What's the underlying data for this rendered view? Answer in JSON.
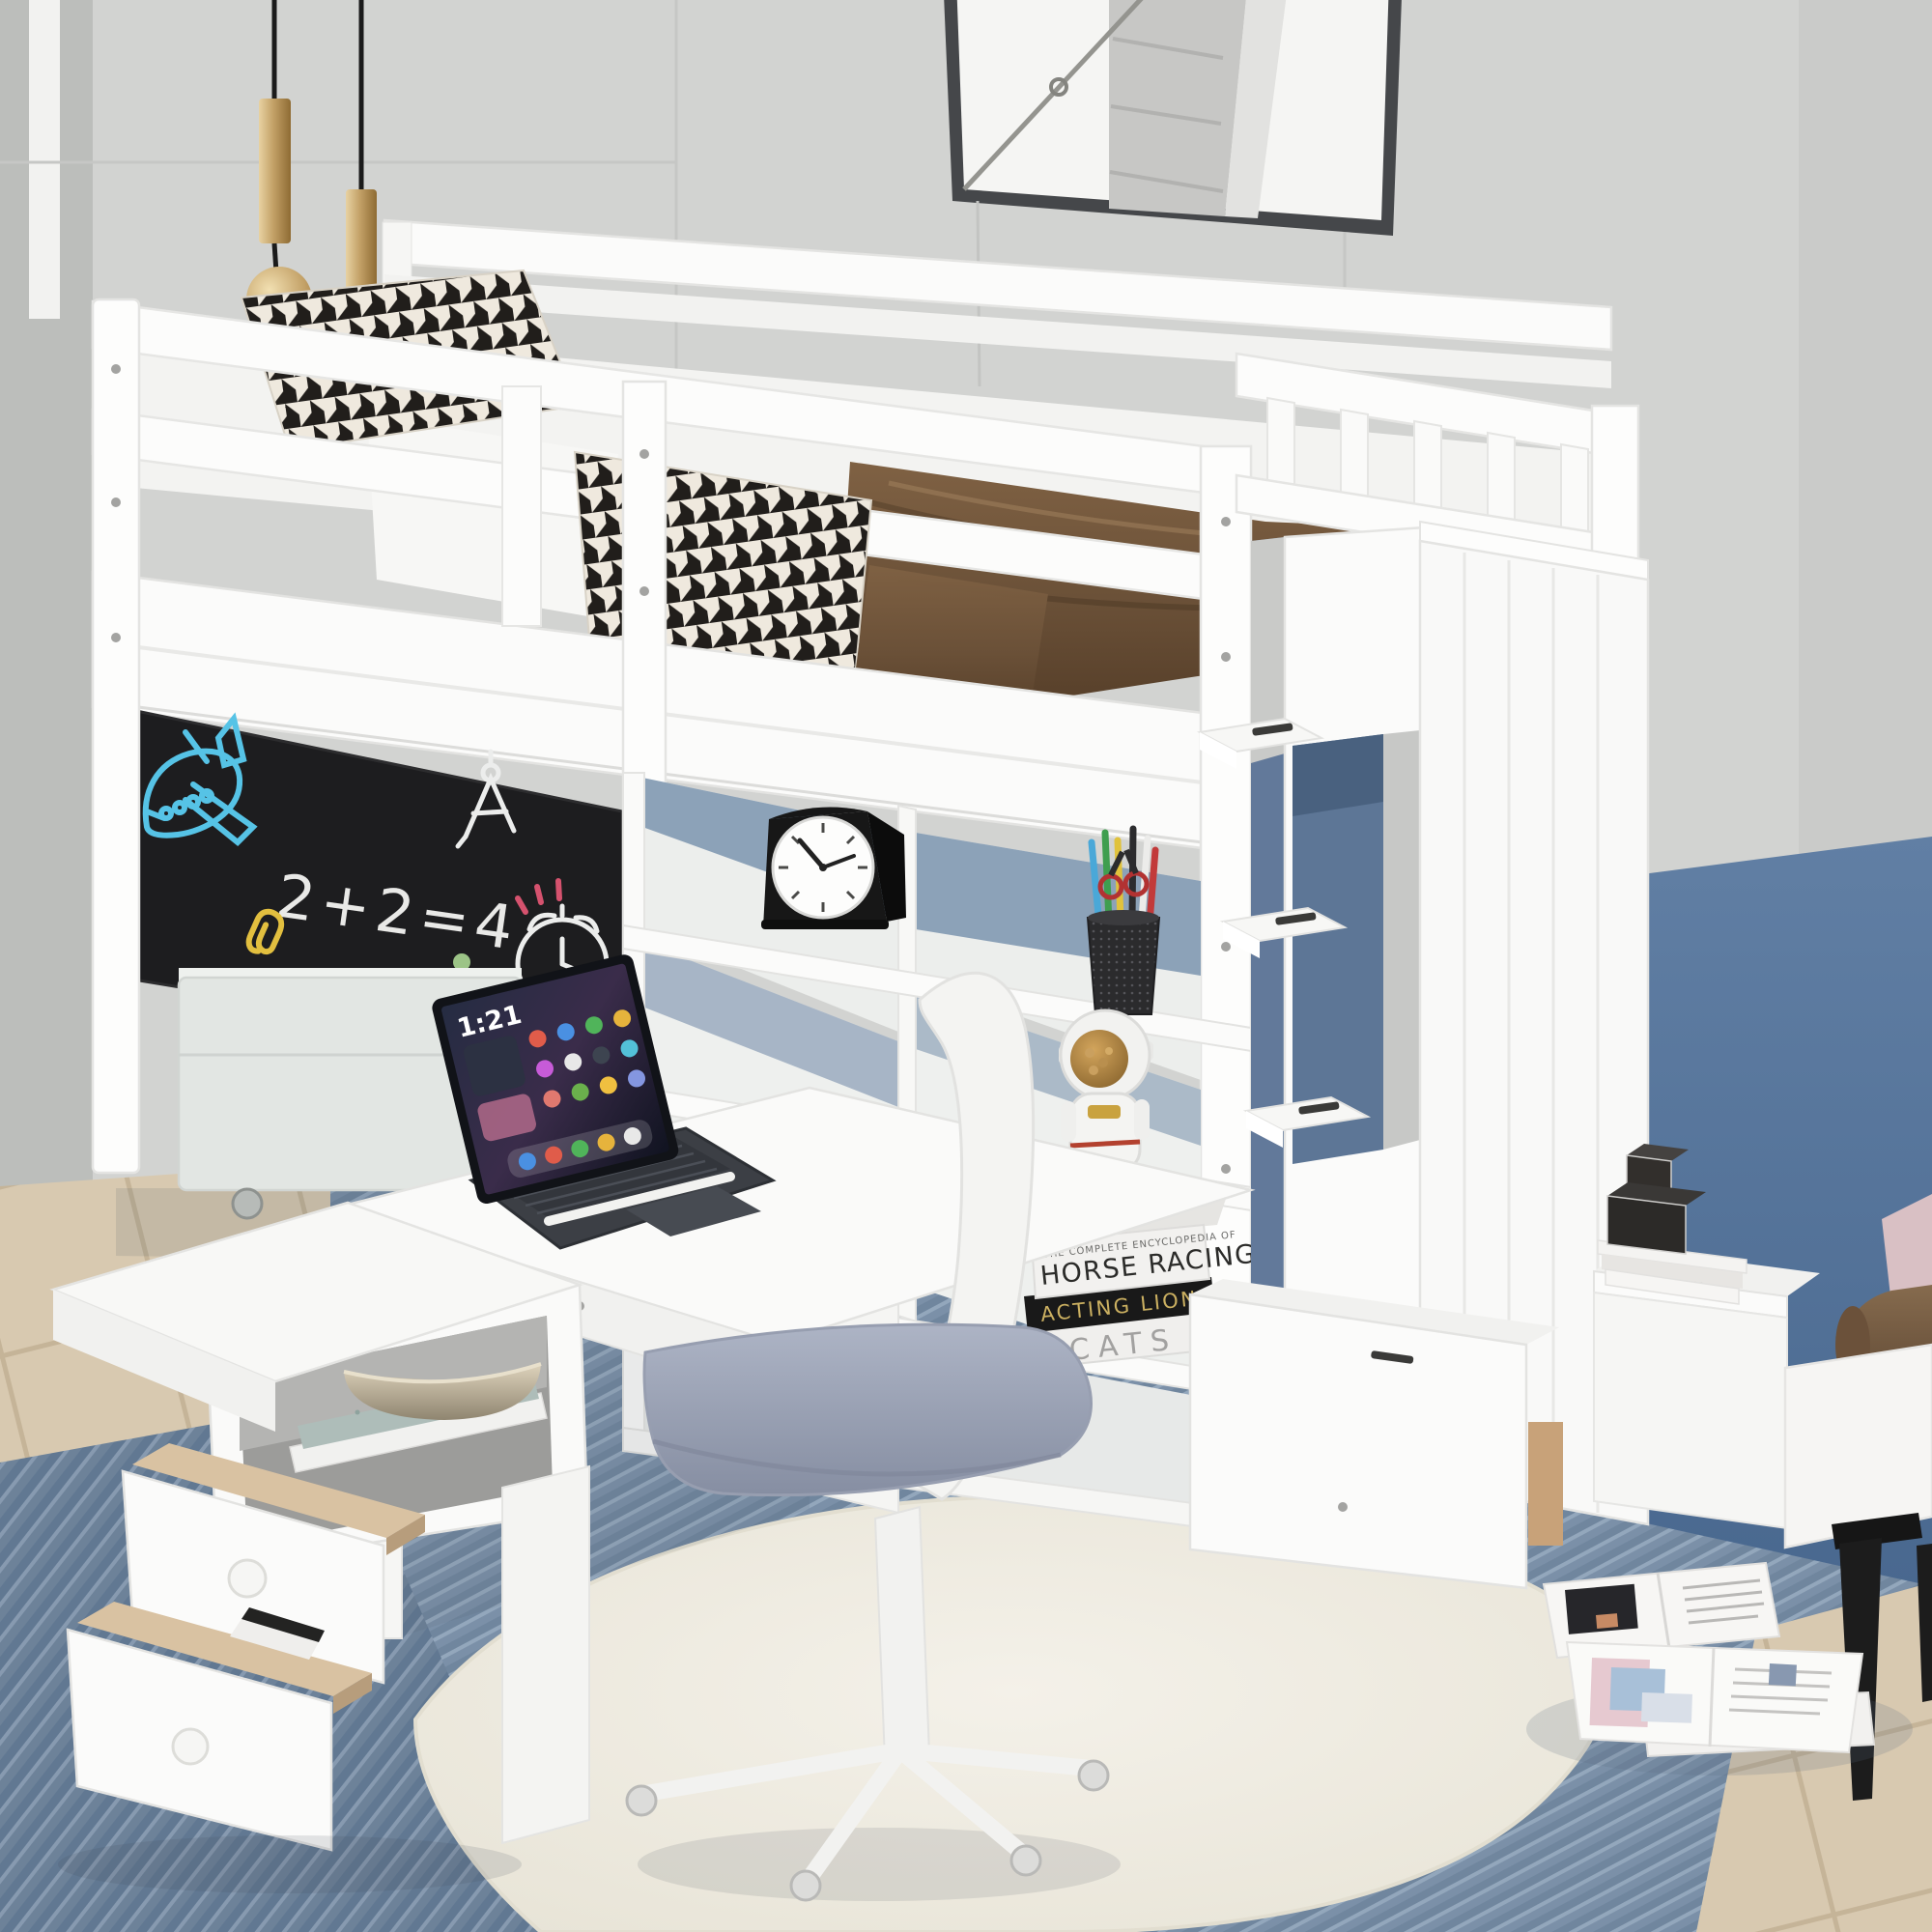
{
  "scene": {
    "type": "product-photo",
    "subject": "White twin loft bed with storage staircase, built-in desk, shelves and chalkboard",
    "room": "kids bedroom with gray paneled wall, blue accent wall, blue rug, cream round rug and beige tile floor"
  },
  "wall_art": {
    "name": "framed black-and-white sail print"
  },
  "pendant_lights": {
    "name": "brass pendant lights",
    "count": "2"
  },
  "chalkboard": {
    "equation": "2+2=4",
    "doodles": [
      "airplane",
      "drafting-compass",
      "paperclip",
      "dots",
      "alarm-clock"
    ],
    "chalk_colors": {
      "airplane": "#56c3e6",
      "equation": "#e9e9e7",
      "paperclip": "#e2bf3f",
      "dots": "#9cc487",
      "clock": "#ecedec",
      "accents": "#d5526e"
    }
  },
  "tablet": {
    "time": "1:21",
    "accessory": "white stylus on dark keyboard"
  },
  "desk_clock": {
    "style": "black carriage clock with white dial"
  },
  "pen_cup": {
    "contents": [
      "blue pencil",
      "green pencil",
      "yellow pencil",
      "red pen",
      "black pens",
      "scissors"
    ]
  },
  "figurine": {
    "name": "astronaut jar with snacks"
  },
  "shelf_books": [
    {
      "series": "THE COMPLETE ENCYCLOPEDIA OF",
      "title": "HORSE RACING",
      "cover": "white with black horse"
    },
    {
      "title": "ACTING LIONS",
      "cover": "black with gold lettering"
    },
    {
      "title": "CATS",
      "cover": "white with gray lettering"
    }
  ],
  "side_shelf": {
    "book_spine": "ANNA K",
    "decor": [
      "two black gift boxes",
      "stack of white books"
    ]
  },
  "bowl_cubby": {
    "decor": "champagne metal bowl on stacked trays"
  },
  "floor_items": {
    "magazines": "two open magazines and a white book on the rug"
  },
  "palette": {
    "wall": "#d2d3d1",
    "accent_wall": "#56779e",
    "rug_blue": "#8096ad",
    "rug_cream": "#f1eee4",
    "tile": "#d8c9b0",
    "furniture_white": "#fbfbfb",
    "chalkboard": "#1d1d1f",
    "blanket_brown": "#6b5138",
    "brass": "#c3a167"
  }
}
